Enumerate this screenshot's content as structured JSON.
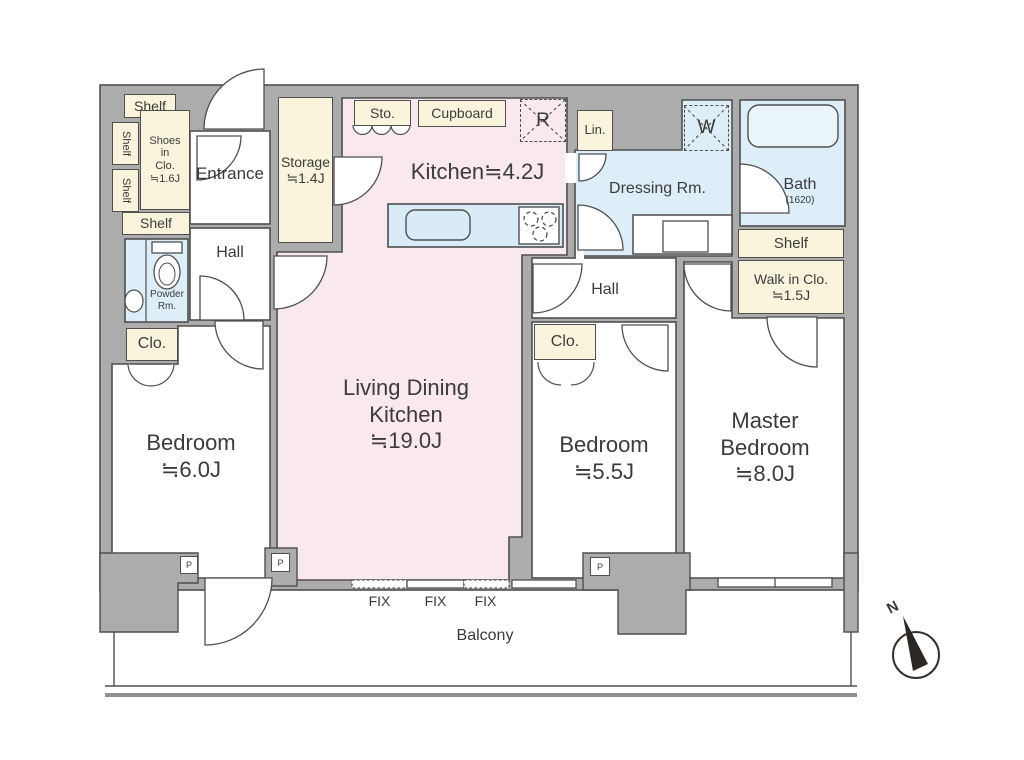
{
  "colors": {
    "wall": "#ACACAC",
    "outline": "#4f4f4f",
    "ldk_pink": "#FAE8EF",
    "wet_blue": "#DEEEF8",
    "counter_blue": "#D9EBF7",
    "closet_cream": "#FAF4DC",
    "text": "#3b3b3b"
  },
  "rooms": {
    "entrance": "Entrance",
    "hall_left": "Hall",
    "hall_right": "Hall",
    "powder_lines": [
      "Powder",
      "Rm."
    ],
    "kitchen": "Kitchen≒4.2J",
    "ldk_lines": [
      "Living Dining",
      "Kitchen",
      "≒19.0J"
    ],
    "dressing": "Dressing Rm.",
    "bath": "Bath",
    "bath_spec": "(1620)",
    "bedroom_left_lines": [
      "Bedroom",
      "≒6.0J"
    ],
    "bedroom_mid_lines": [
      "Bedroom",
      "≒5.5J"
    ],
    "master_lines": [
      "Master",
      "Bedroom",
      "≒8.0J"
    ],
    "balcony": "Balcony"
  },
  "storage": {
    "shelf_top": "Shelf",
    "shelf_side_upper": "Shelf",
    "shelf_side_lower": "Shelf",
    "shelf_entry": "Shelf",
    "shoes_lines": [
      "Shoes",
      "in",
      "Clo.",
      "≒1.6J"
    ],
    "storage_lines": [
      "Storage",
      "≒1.4J"
    ],
    "sto": "Sto.",
    "cupboard": "Cupboard",
    "lin": "Lin.",
    "clo_left": "Clo.",
    "clo_right": "Clo.",
    "shelf_bath": "Shelf",
    "wic_lines": [
      "Walk in Clo.",
      "≒1.5J"
    ]
  },
  "markers": {
    "refrigerator": "R",
    "washer": "W",
    "pillar": "P",
    "fix_window": "FIX",
    "compass_north": "N"
  }
}
